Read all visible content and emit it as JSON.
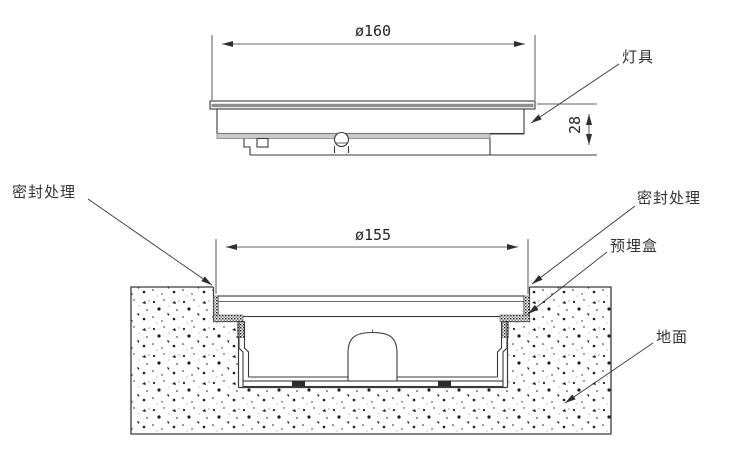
{
  "top_view": {
    "diameter_dim": "ø160",
    "height_dim": "28",
    "fixture_label": "灯具"
  },
  "section_view": {
    "diameter_dim": "ø155",
    "seal_label_left": "密封处理",
    "seal_label_right": "密封处理",
    "embedded_box_label": "预埋盒",
    "ground_label": "地面"
  },
  "colors": {
    "line": "#3a3a3a",
    "dimension_line": "#2f2f2f",
    "flange_band_gray": "#8f8f8f",
    "shelf_gray": "#c9c9c9",
    "background": "#ffffff"
  }
}
